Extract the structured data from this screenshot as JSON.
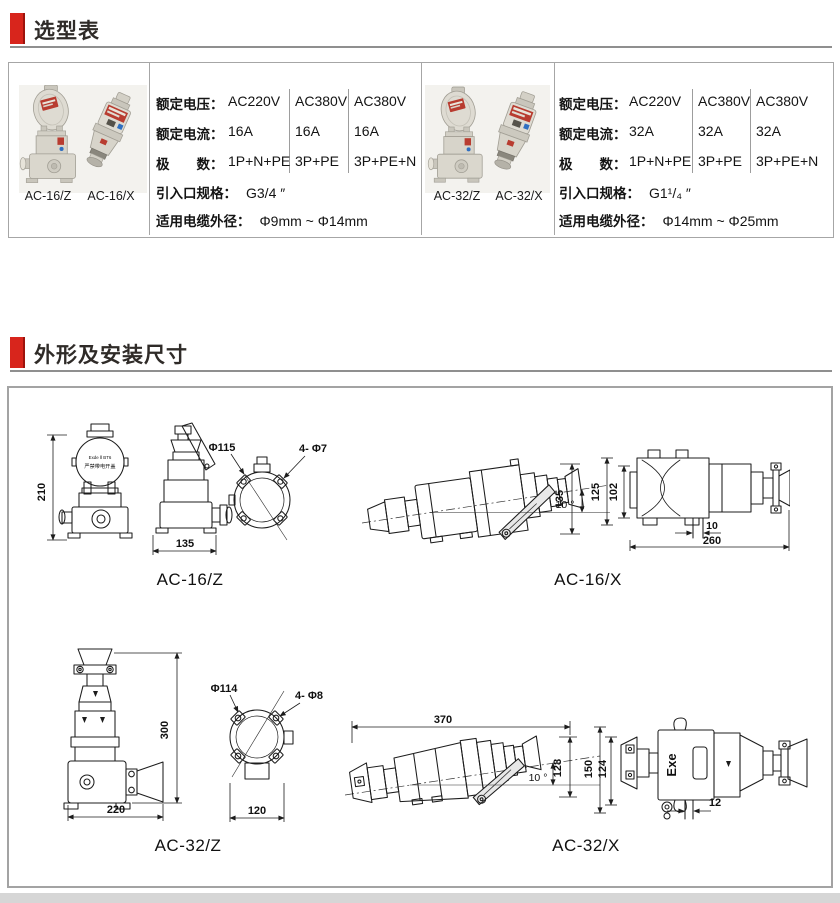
{
  "accent_color": "#d8251c",
  "sections": [
    {
      "title": "选型表"
    },
    {
      "title": "外形及安装尺寸"
    }
  ],
  "table": {
    "row_labels": [
      "额定电压：",
      "额定电流：",
      "极　　数："
    ],
    "groups": [
      {
        "photo_labels": [
          "AC-16/Z",
          "AC-16/X"
        ],
        "columns": [
          [
            "AC220V",
            "16A",
            "1P+N+PE"
          ],
          [
            "AC380V",
            "16A",
            "3P+PE"
          ],
          [
            "AC380V",
            "16A",
            "3P+PE+N"
          ]
        ],
        "inlet_label": "引入口规格：",
        "inlet_value": "G3/4 ″",
        "cable_label": "适用电缆外径：",
        "cable_value": "Φ9mm ~ Φ14mm"
      },
      {
        "photo_labels": [
          "AC-32/Z",
          "AC-32/X"
        ],
        "columns": [
          [
            "AC220V",
            "32A",
            "1P+N+PE"
          ],
          [
            "AC380V",
            "32A",
            "3P+PE"
          ],
          [
            "AC380V",
            "32A",
            "3P+PE+N"
          ]
        ],
        "inlet_label": "引入口规格：",
        "inlet_value": "G1¹/₄ ″",
        "cable_label": "适用电缆外径：",
        "cable_value": "Φ14mm ~ Φ25mm"
      }
    ]
  },
  "drawings": {
    "ac16z": {
      "label": "AC-16/Z",
      "dim_height": "210",
      "dim_width": "135",
      "dim_circle": "Φ115",
      "dim_holes": "4- Φ7",
      "plate_line1": "Exde Ⅱ BT6",
      "plate_line2": "严禁带电开盖"
    },
    "ac16x": {
      "label": "AC-16/X",
      "angle": "10 °",
      "dim_height": "135",
      "dim_h2": "125",
      "dim_h3": "102",
      "dim_w1": "10",
      "dim_w2": "260"
    },
    "ac32z": {
      "label": "AC-32/Z",
      "dim_height": "300",
      "dim_width": "220",
      "dim_circle": "Φ114",
      "dim_holes": "4- Φ8",
      "dim_w2": "120"
    },
    "ac32x": {
      "label": "AC-32/X",
      "dim_length": "370",
      "angle": "10 °",
      "dim_height": "128",
      "dim_h2": "150",
      "dim_h3": "124",
      "dim_w1": "12",
      "body_text": "Exe"
    }
  }
}
